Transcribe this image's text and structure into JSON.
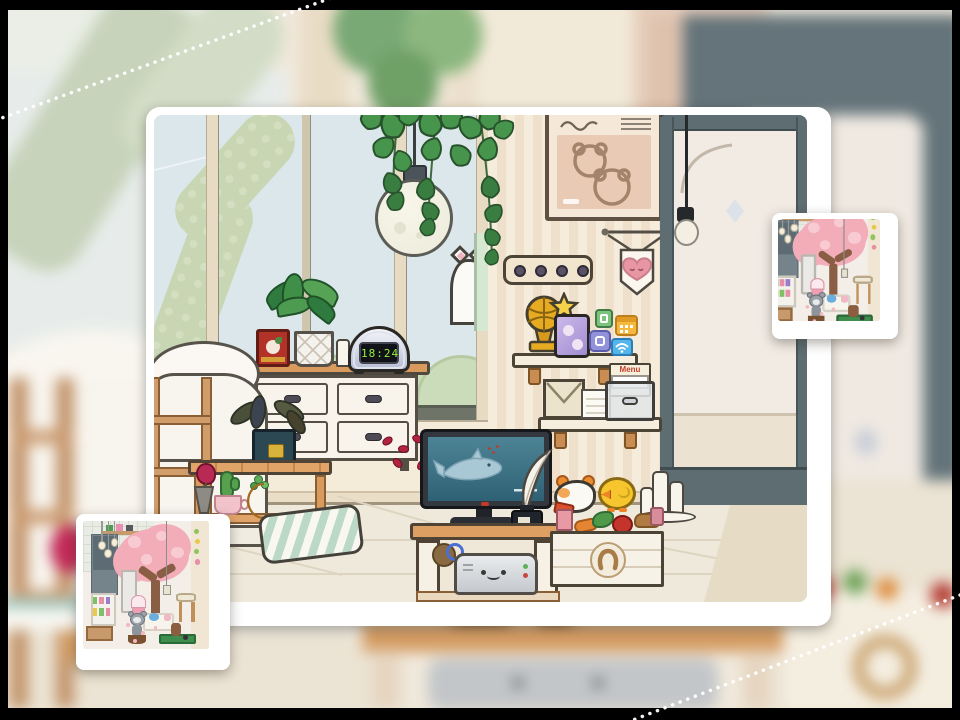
{
  "scene": {
    "type": "cozy-room-photo-viewer",
    "clock_time": "18:24",
    "menu_label": "Menu",
    "main_photo": {
      "objects": [
        "window-garden-view",
        "ivy-arch",
        "bushes",
        "hanging-ivy",
        "moon-pendant-lamp",
        "peeking-cat",
        "wall-poster-bears",
        "heart-pennant",
        "wall-hook-rack",
        "glass-door",
        "hanging-bulb",
        "diamond-door-knob",
        "trophy",
        "tablet",
        "app-icons",
        "wall-shelf-top",
        "wall-shelf-bottom",
        "envelope",
        "paper-stack",
        "storage-box",
        "menu-book",
        "dresser",
        "red-tin",
        "potted-plant",
        "small-candle",
        "alarm-clock",
        "bed",
        "blanket-ladder",
        "side-bench",
        "dead-plant",
        "rose-in-vase",
        "cactus-cup",
        "moon-planter",
        "striped-pillow",
        "rose-petals",
        "tv-ocean-scene",
        "quill-and-ink",
        "tv-stand",
        "cable-spool",
        "game-console",
        "hamster-plush",
        "chick-plush",
        "pillar-candles",
        "vegetable-crate-horseshoe"
      ]
    },
    "thumbnails": {
      "left": {
        "description": "cherry-blossom-room-photo"
      },
      "right": {
        "description": "cherry-blossom-room-photo-zoomed"
      }
    },
    "background": {
      "description": "same-room-blurred-with-dashed-guide-lines",
      "objects": [
        "blurred-door",
        "blurred-poster",
        "blurred-bed",
        "blurred-ladder",
        "blurred-tv-stand",
        "blurred-console",
        "blurred-crate",
        "dashed-guide-lines"
      ]
    },
    "colors": {
      "wall": "#f5ead8",
      "door_frame": "#5d6d71",
      "accent_pink": "#e996a4",
      "tree_pink": "#f2adb9",
      "clock_digits": "#93f23c",
      "tv_screen": "#417e92",
      "wood": "#d89a61",
      "frame_black": "#000000"
    }
  }
}
